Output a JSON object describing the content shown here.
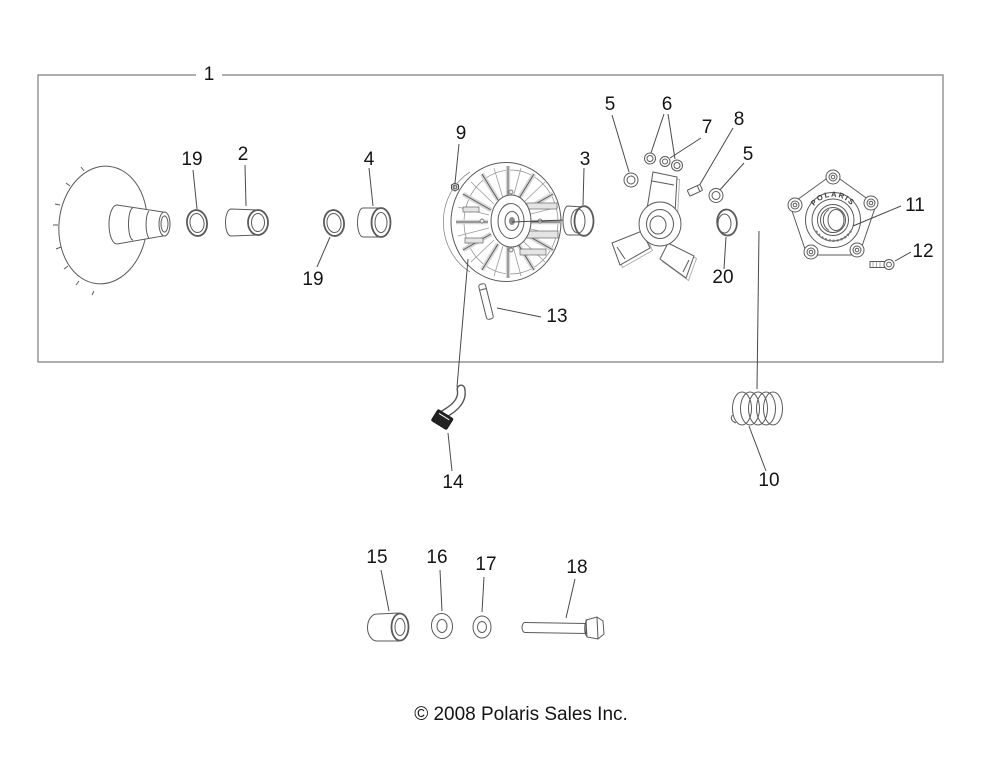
{
  "diagram": {
    "copyright": "© 2008 Polaris Sales Inc.",
    "cover_plate_text": "POLARIS",
    "callouts": {
      "n1": "1",
      "n2": "2",
      "n3": "3",
      "n4": "4",
      "n5a": "5",
      "n5b": "5",
      "n6": "6",
      "n7": "7",
      "n8": "8",
      "n9": "9",
      "n10": "10",
      "n11": "11",
      "n12": "12",
      "n13": "13",
      "n14": "14",
      "n15": "15",
      "n16": "16",
      "n17": "17",
      "n18": "18",
      "n19a": "19",
      "n19b": "19",
      "n20": "20"
    }
  }
}
